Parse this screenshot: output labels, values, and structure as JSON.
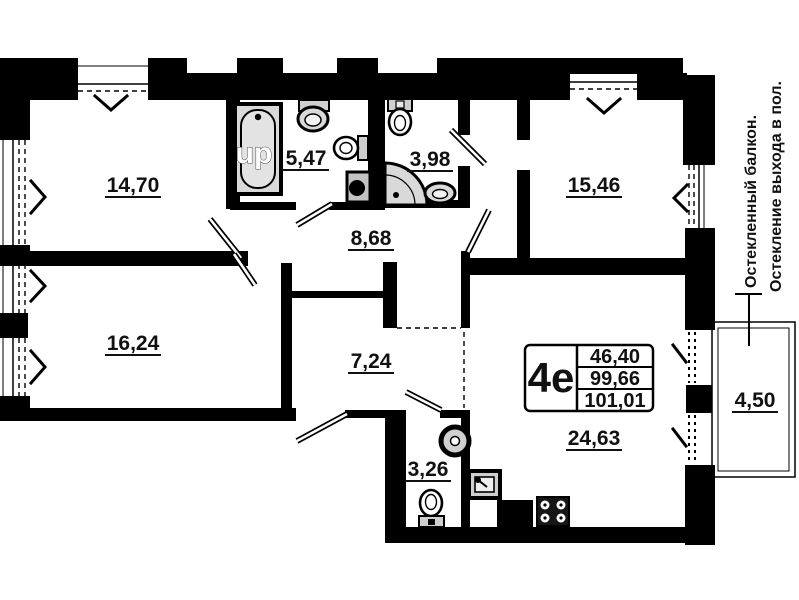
{
  "unit_card": {
    "type_label": "4е",
    "area_rows": [
      "46,40",
      "99,66",
      "101,01"
    ]
  },
  "room_labels": {
    "bedroom1": "14,70",
    "bathroom": "5,47",
    "bathroom2": "3,98",
    "bedroom2": "15,46",
    "hall": "8,68",
    "bedroom3": "16,24",
    "corridor": "7,24",
    "wc": "3,26",
    "kitchen_living": "24,63",
    "balcony": "4,50"
  },
  "notes": {
    "balcony_line1": "Остекленный балкон.",
    "balcony_line2": "Остекление выхода в пол."
  },
  "watermark": "up",
  "colors": {
    "wall": "#000000",
    "background": "#ffffff",
    "fixture_fill": "#d9d9d9"
  }
}
